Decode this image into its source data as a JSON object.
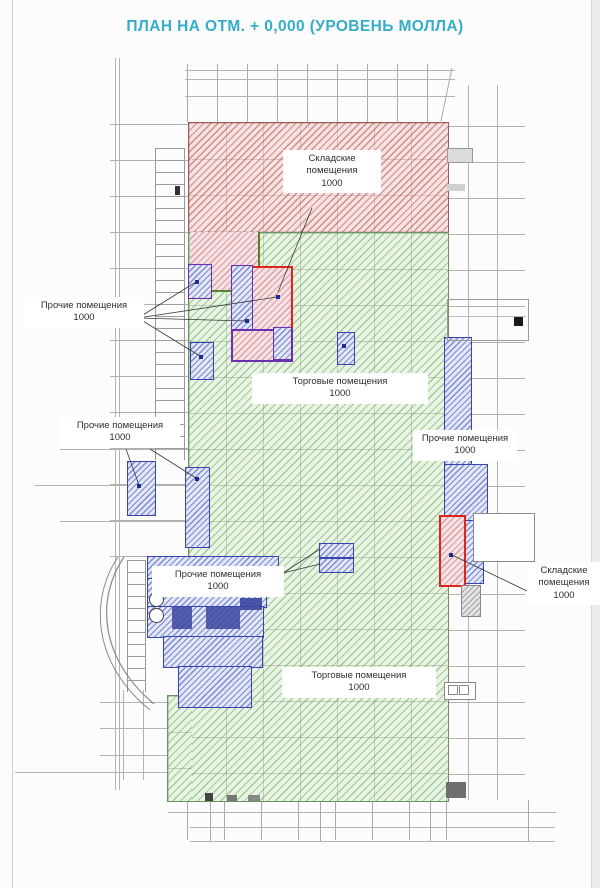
{
  "title": "ПЛАН НА ОТМ. + 0,000 (УРОВЕНЬ МОЛЛА)",
  "labels": {
    "storage_top": {
      "name": "Складские помещения",
      "value": "1000"
    },
    "other_upper_left": {
      "name": "Прочие помещения",
      "value": "1000"
    },
    "retail_center": {
      "name": "Торговые помещения",
      "value": "1000"
    },
    "other_mid_left": {
      "name": "Прочие помещения",
      "value": "1000"
    },
    "other_right": {
      "name": "Прочие помещения",
      "value": "1000"
    },
    "other_bottom_left": {
      "name": "Прочие помещения",
      "value": "1000"
    },
    "storage_right": {
      "name": "Складские помещения",
      "value": "1000"
    },
    "retail_bottom": {
      "name": "Торговые помещения",
      "value": "1000"
    }
  },
  "colors": {
    "title": "#35adc8",
    "storage_zone": "#b24640",
    "retail_zone": "#5aa055",
    "other_zone": "#3646b0",
    "highlight_red": "#df2418",
    "highlight_purple": "#6a30b0",
    "grid_line": "#b3b3b3"
  }
}
